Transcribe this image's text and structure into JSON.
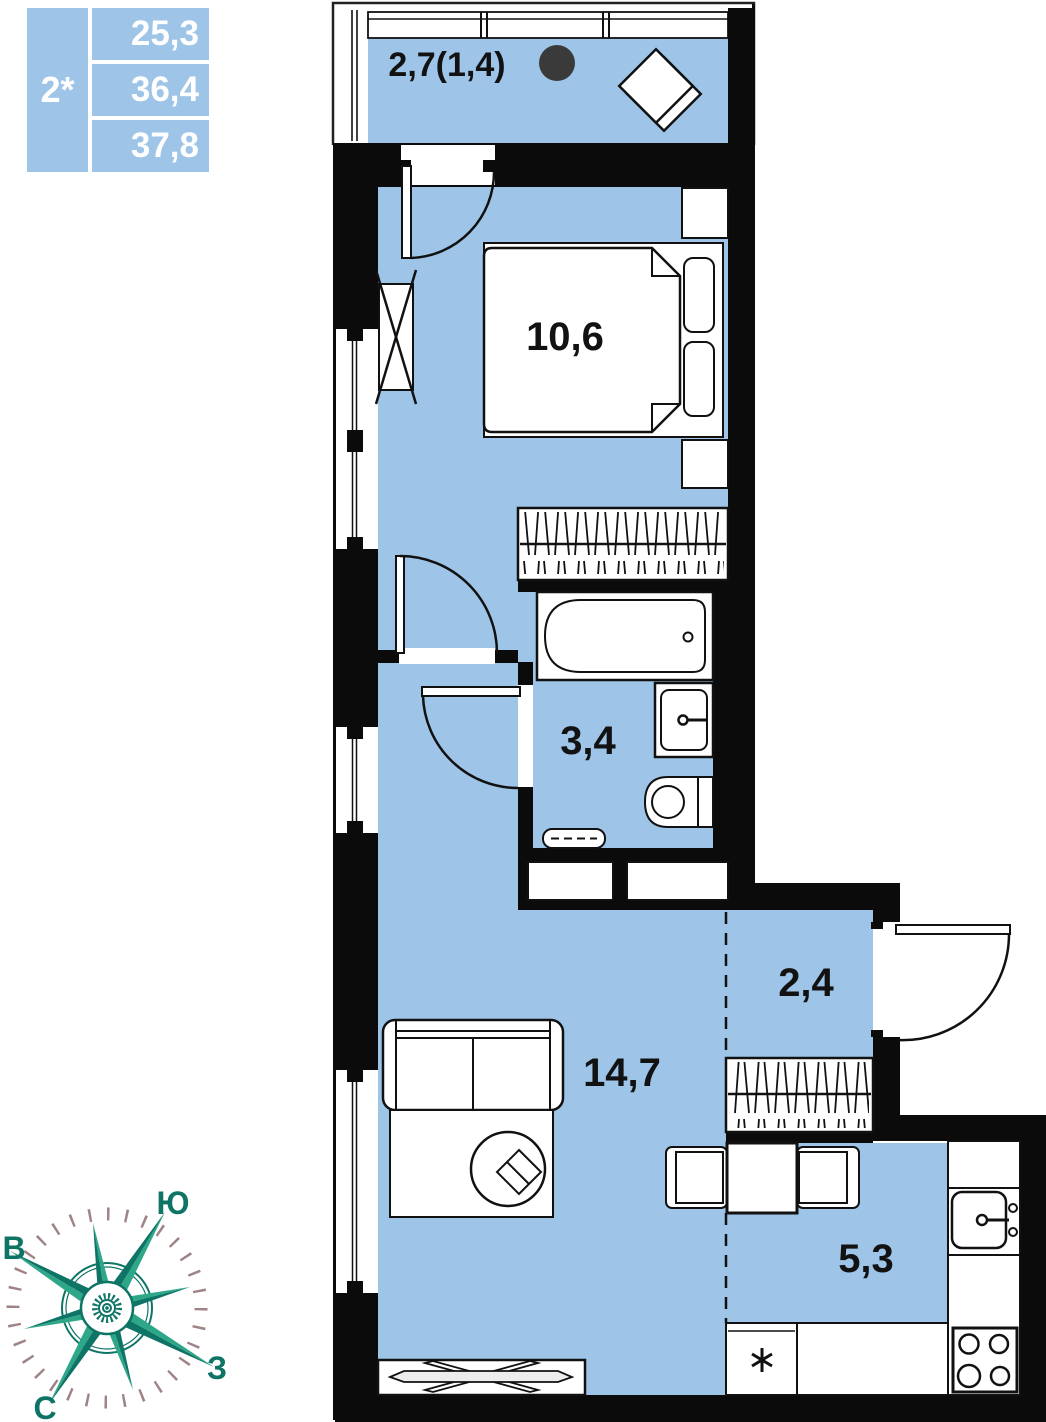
{
  "info_card": {
    "rooms_count": "2*",
    "area_living": "25,3",
    "area_apartment": "36,4",
    "area_total": "37,8"
  },
  "rooms": {
    "balcony": "2,7(1,4)",
    "bedroom": "10,6",
    "bathroom": "3,4",
    "living_room": "14,7",
    "hallway": "2,4",
    "kitchen": "5,3"
  },
  "compass": {
    "label_south": "Ю",
    "label_east": "В",
    "label_west": "З",
    "label_north": "С"
  },
  "colors": {
    "room_fill": "#9ec5e8",
    "wall": "#0b0b0b",
    "compass_light": "#2EA788",
    "compass_dark": "#0E7465",
    "compass_ticks": "#9f8486"
  }
}
